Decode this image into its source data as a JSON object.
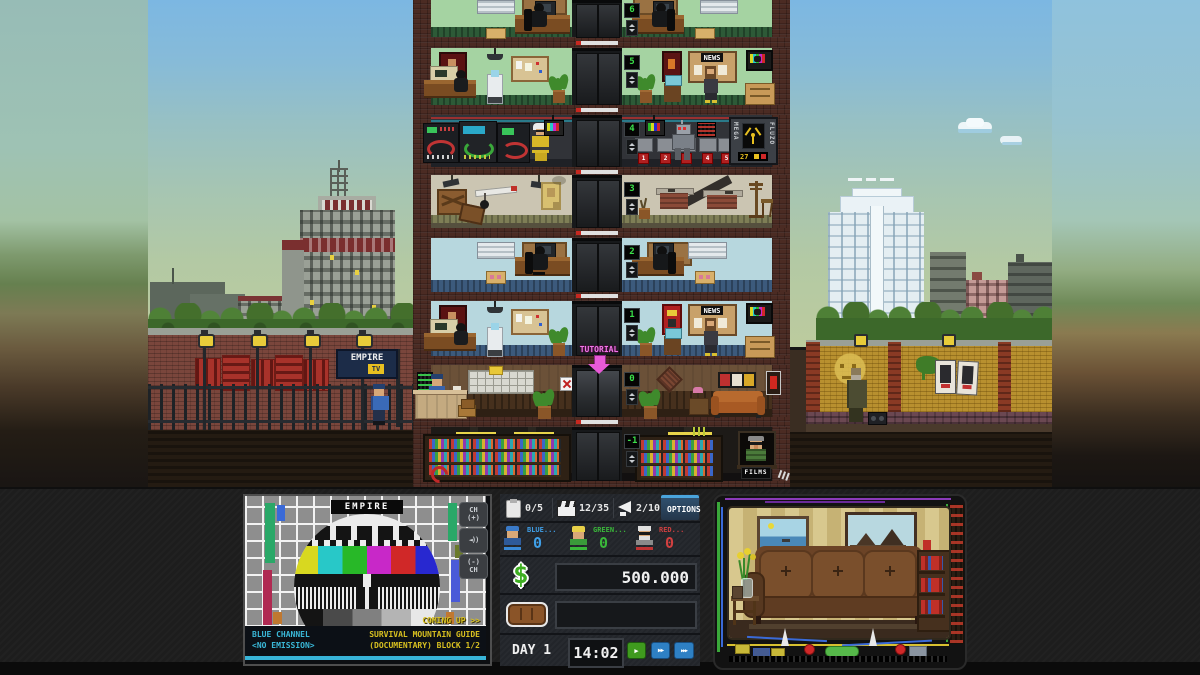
{
  "scene": {
    "empire_watermark": "EMPIRE",
    "tutorial_label": "TUTORIAL",
    "news_label": "NEWS",
    "films_label": "FILMS",
    "street_sign": {
      "name": "EMPIRE",
      "tv": "TV"
    },
    "flux_machine": {
      "left": "MEGA",
      "right": "FLUZO",
      "counter": "27"
    },
    "floors": [
      {
        "led": "6"
      },
      {
        "led": "5"
      },
      {
        "led": "4"
      },
      {
        "led": "3"
      },
      {
        "led": "2"
      },
      {
        "led": "1"
      },
      {
        "led": "0"
      },
      {
        "led": "-1"
      }
    ],
    "stand_numbers": [
      "1",
      "2",
      "3",
      "4",
      "5"
    ]
  },
  "tv_preview": {
    "station": "EMPIRE",
    "ch_up_line1": "CH",
    "ch_up_line2": "(+)",
    "ch_down_line1": "(-)",
    "ch_down_line2": "CH",
    "speaker_glyph": "◄))",
    "now_line1": "BLUE CHANNEL",
    "now_line2": "<NO EMISSION>",
    "coming_up": "COMING UP >>",
    "next_line1": "SURVIVAL MOUNTAIN GUIDE",
    "next_line2": "(DOCUMENTARY) BLOCK 1/2"
  },
  "hud": {
    "scripts": "0/5",
    "movies": "12/35",
    "ads": "2/10",
    "options_label": "OPTIONS",
    "channels": [
      {
        "label": "BLUE...",
        "value": "0",
        "color": "#3f9fe8"
      },
      {
        "label": "GREEN...",
        "value": "0",
        "color": "#3ab83a"
      },
      {
        "label": "RED...",
        "value": "0",
        "color": "#d04040"
      }
    ],
    "money": "500.000",
    "day": "DAY 1",
    "time": "14:02",
    "play": "▶",
    "ff": "▶▶",
    "fff": "▶▶▶"
  }
}
